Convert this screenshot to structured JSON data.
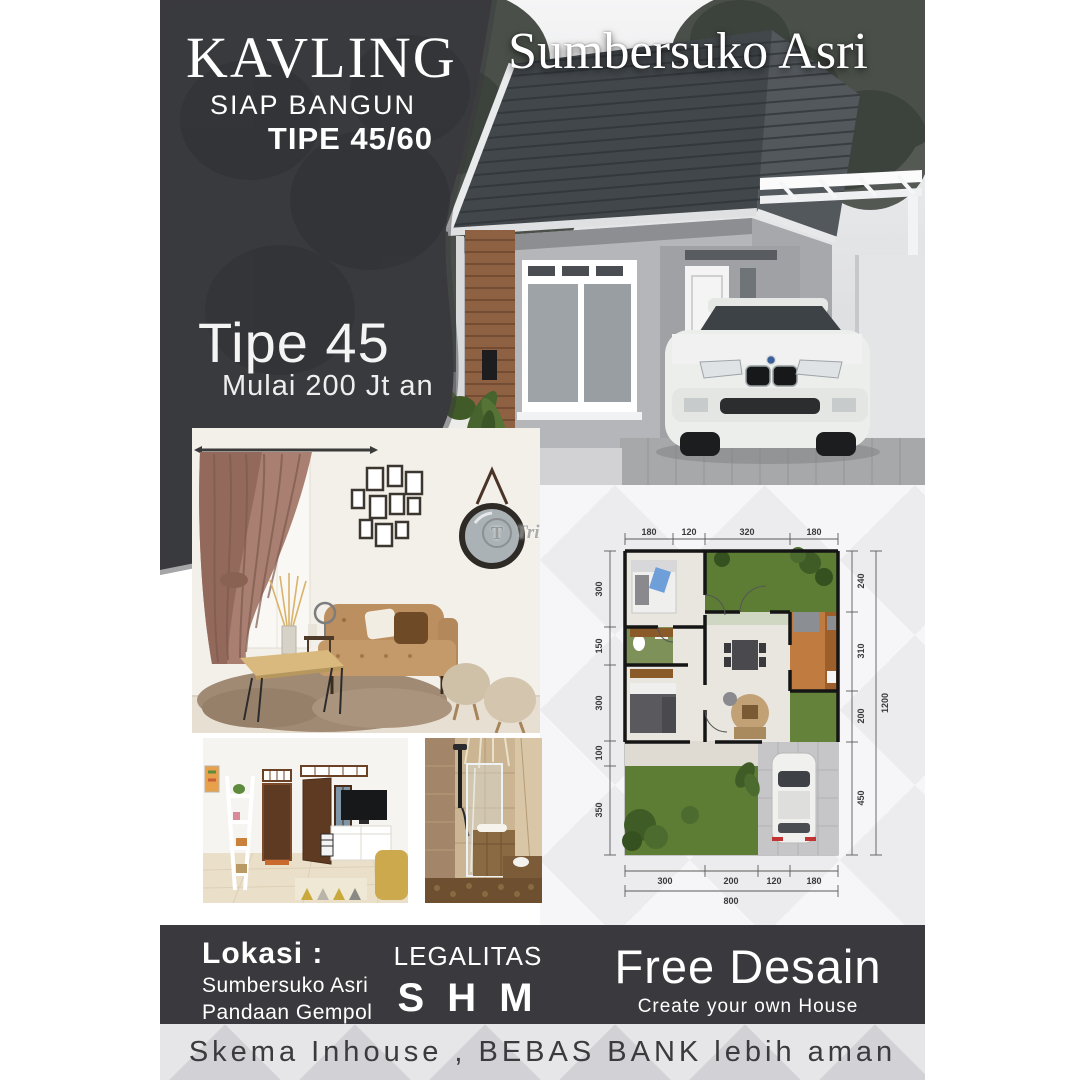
{
  "banner": {
    "title": "KAVLING",
    "subtitle": "SIAP BANGUN",
    "type": "TIPE 45/60"
  },
  "hero": {
    "project_name": "Sumbersuko Asri",
    "offer_title": "Tipe 45",
    "offer_subtitle": "Mulai 200 Jt an"
  },
  "watermark": {
    "initial": "T",
    "text": "TribunJualBeli"
  },
  "floor_plan": {
    "dims_top": [
      "180",
      "120",
      "320",
      "180"
    ],
    "dims_left": [
      "300",
      "150",
      "300",
      "100",
      "350"
    ],
    "dims_right": [
      "240",
      "310",
      "200",
      "450"
    ],
    "dim_right_total": "1200",
    "dims_bottom": [
      "300",
      "200",
      "120",
      "180"
    ],
    "dim_bottom_total": "800"
  },
  "footer": {
    "lokasi_label": "Lokasi :",
    "lokasi_line1": "Sumbersuko Asri",
    "lokasi_line2": "Pandaan Gempol",
    "legalitas_label": "LEGALITAS",
    "legalitas_value": "S H M",
    "free_design_title": "Free Desain",
    "free_design_subtitle": "Create your own House"
  },
  "strip": {
    "text": "Skema Inhouse , BEBAS BANK lebih aman"
  },
  "colors": {
    "dark_panel": "#3a3a3e",
    "strip_bg": "#d2d2d6",
    "garden_green": "#5d7d35",
    "kitchen_orange": "#bf7b40"
  }
}
